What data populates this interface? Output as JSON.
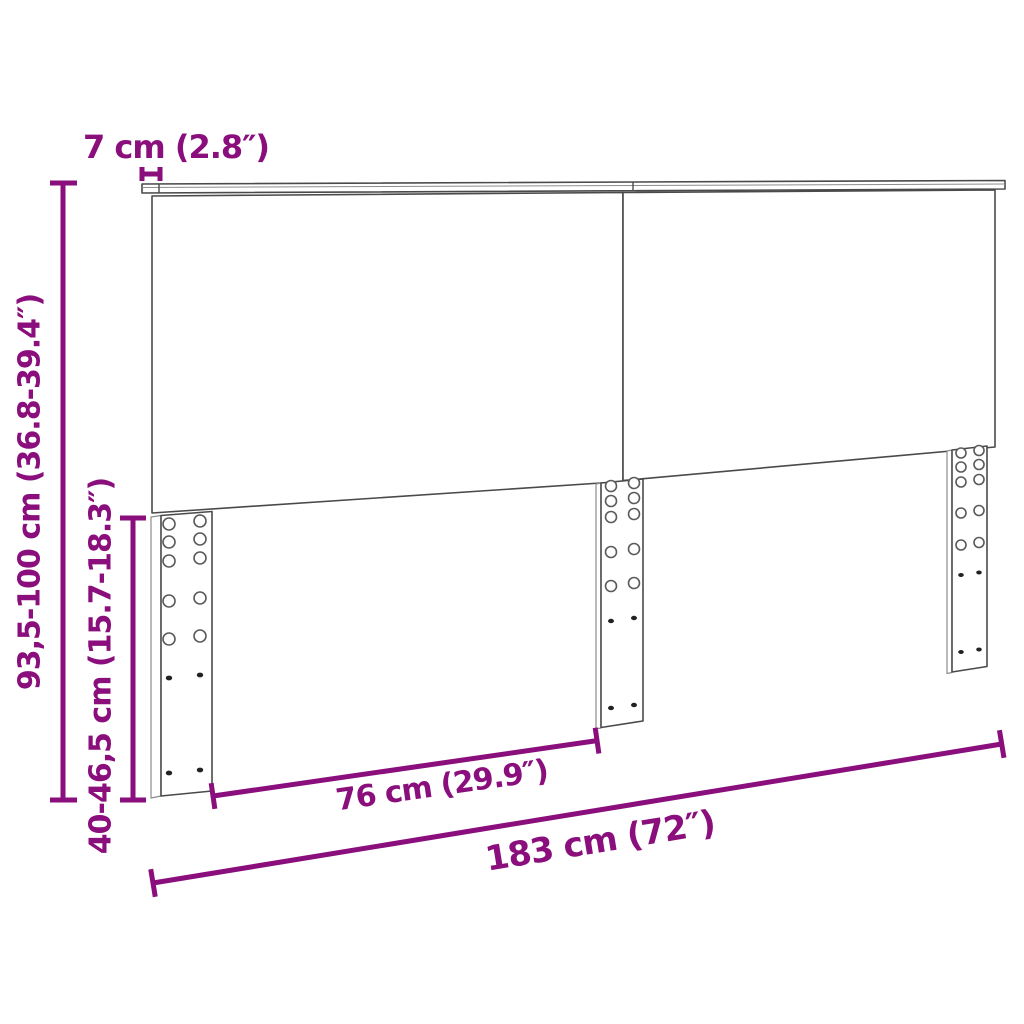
{
  "colors": {
    "accent": "#8A0E7C",
    "line": "#4A4A4A",
    "line_light": "#8C8C8C",
    "background": "#FFFFFF"
  },
  "diagram": {
    "type": "product-dimension-diagram",
    "subject": "headboard-two-panels-with-adjustable-slotted-legs",
    "labels": {
      "top_depth": "7 cm (2.8″)",
      "total_height": "93,5-100 cm (36.8-39.4″)",
      "leg_height": "40-46,5 cm (15.7-18.3″)",
      "panel_width": "76 cm (29.9″)",
      "total_width": "183 cm (72″)"
    }
  }
}
